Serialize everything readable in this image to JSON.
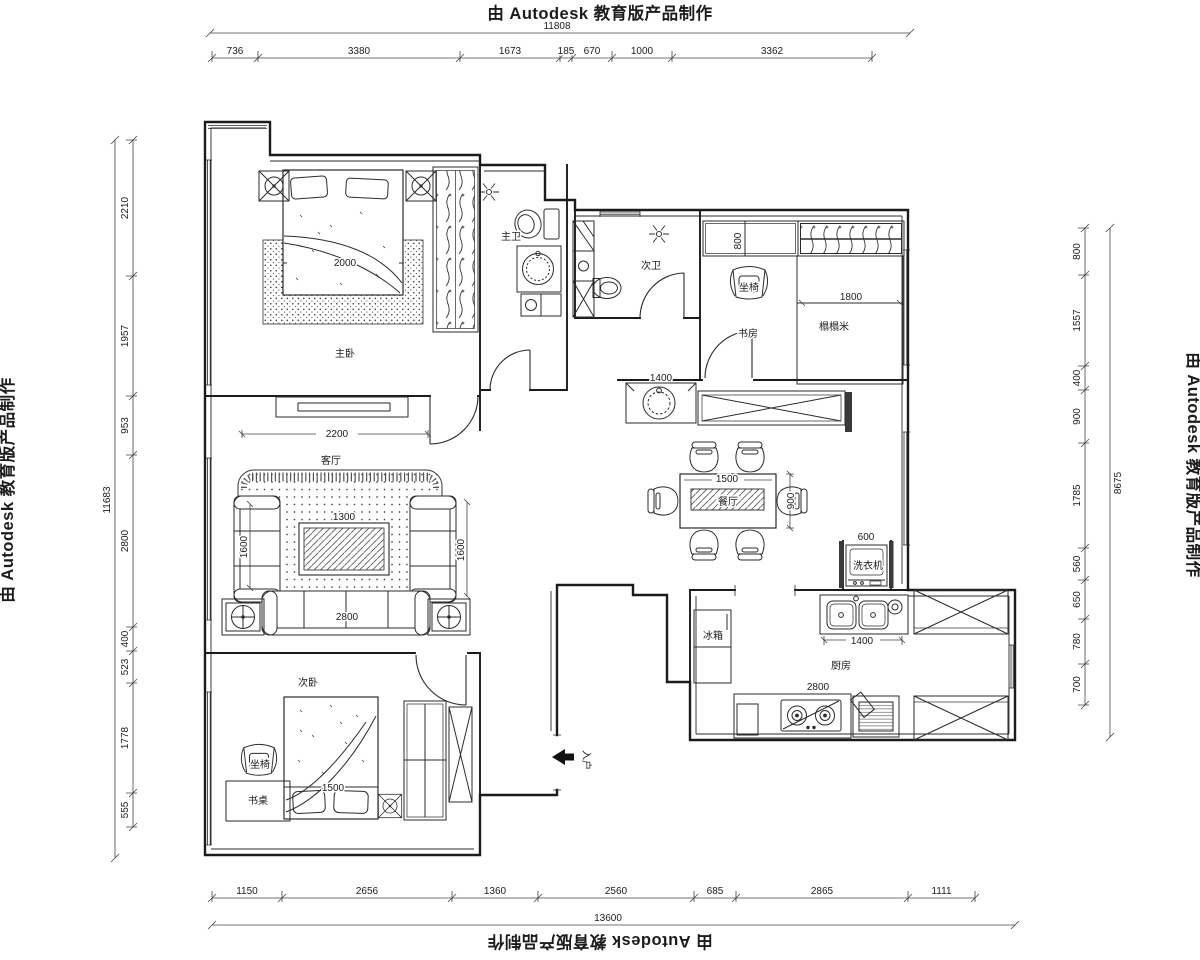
{
  "autodesk_stamp": "由 Autodesk 教育版产品制作",
  "dimensions": {
    "top": {
      "total": "11808",
      "segments": [
        "736",
        "3380",
        "1673",
        "185",
        "670",
        "1000",
        "3362"
      ]
    },
    "left": {
      "total": "11683",
      "segments": [
        "2210",
        "1957",
        "953",
        "2800",
        "400",
        "523",
        "1778",
        "555"
      ]
    },
    "right": {
      "total": "8675",
      "segments": [
        "800",
        "1557",
        "400",
        "900",
        "1785",
        "560",
        "650",
        "780",
        "700"
      ]
    },
    "bottom": {
      "total": "13600",
      "segments": [
        "1150",
        "2656",
        "1360",
        "2560",
        "685",
        "2865",
        "1111"
      ]
    }
  },
  "interior_dimensions": [
    {
      "id": "master-bed-width",
      "value": "2000"
    },
    {
      "id": "tv-wall",
      "value": "2200"
    },
    {
      "id": "coffee-table",
      "value": "1300"
    },
    {
      "id": "sofa-left",
      "value": "1600"
    },
    {
      "id": "sofa-right",
      "value": "1600"
    },
    {
      "id": "sofa-long",
      "value": "2800"
    },
    {
      "id": "closet-depth",
      "value": "800"
    },
    {
      "id": "tatami-width",
      "value": "1800"
    },
    {
      "id": "basin-cabinet",
      "value": "1400"
    },
    {
      "id": "dining-table-w",
      "value": "1500"
    },
    {
      "id": "dining-table-d",
      "value": "900"
    },
    {
      "id": "washer-w",
      "value": "600"
    },
    {
      "id": "sink-counter",
      "value": "1400"
    },
    {
      "id": "stove-counter",
      "value": "2800"
    },
    {
      "id": "bed2-width",
      "value": "1500"
    }
  ],
  "room_labels": [
    {
      "id": "master-bedroom",
      "label": "主卧"
    },
    {
      "id": "master-bath",
      "label": "主卫"
    },
    {
      "id": "second-bath",
      "label": "次卫"
    },
    {
      "id": "study",
      "label": "书房"
    },
    {
      "id": "tatami",
      "label": "榻榻米"
    },
    {
      "id": "living-room",
      "label": "客厅"
    },
    {
      "id": "dining-room",
      "label": "餐厅"
    },
    {
      "id": "second-bedroom",
      "label": "次卧"
    },
    {
      "id": "kitchen",
      "label": "厨房"
    }
  ],
  "furniture_labels": [
    {
      "id": "desk",
      "label": "书桌"
    },
    {
      "id": "fridge",
      "label": "冰箱"
    },
    {
      "id": "washer",
      "label": "洗衣机"
    },
    {
      "id": "chair-study",
      "label": "坐椅"
    },
    {
      "id": "chair-bedroom",
      "label": "坐椅"
    },
    {
      "id": "entry",
      "label": "入户"
    }
  ]
}
